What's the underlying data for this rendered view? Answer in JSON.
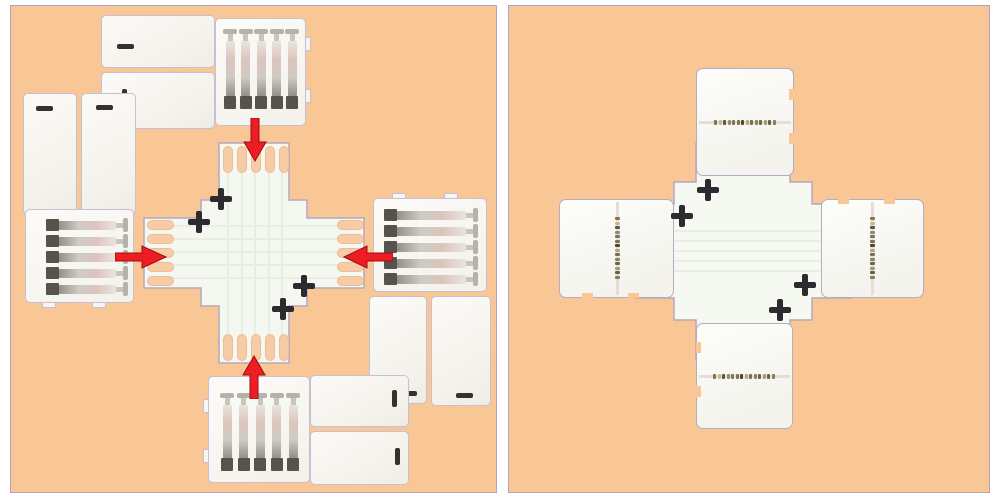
{
  "scene": {
    "type": "product-photo",
    "subject": "5-pin X-shape solderless LED strip connector",
    "panels": [
      {
        "name": "exploded-assembly-view",
        "contents": "four clip connectors with metal pins surrounding an X-shaped PCB with solder pads",
        "arrow_directions": [
          "down",
          "right",
          "left",
          "up"
        ]
      },
      {
        "name": "assembled-view",
        "contents": "X-shaped connector with four clips attached"
      }
    ]
  },
  "counts": {
    "pins_per_connector": 5,
    "pads_per_arm": 5,
    "alignment_marks_per_panel": 4,
    "clip_connectors": 4,
    "red_arrows": 4
  },
  "colors": {
    "page_bg": "#ffffff",
    "panel_bg": "#f9c795",
    "panel_border": "#b2a4bf",
    "conn_border": "#c9bed3",
    "cross_fill": "#f5f7f1",
    "cross_border": "#b4a8c0",
    "pad": "#f7cba6",
    "pad_border": "#eebd93",
    "arrow_red": "#ee1c23",
    "arrow_edge": "#9d0d12",
    "mark": "#2c2c30",
    "pin_dark": "#55534c",
    "seam": "#e2dfd6"
  },
  "contact_dot_colors": [
    "#8a6f4e",
    "#c9ba90",
    "#5d5748",
    "#a3885c",
    "#6e7a68",
    "#8a6f4e",
    "#46483e",
    "#b5a87e",
    "#7c6f4f",
    "#96824f",
    "#5f6b5c",
    "#a89a70",
    "#6b5f45",
    "#8f7b55"
  ]
}
